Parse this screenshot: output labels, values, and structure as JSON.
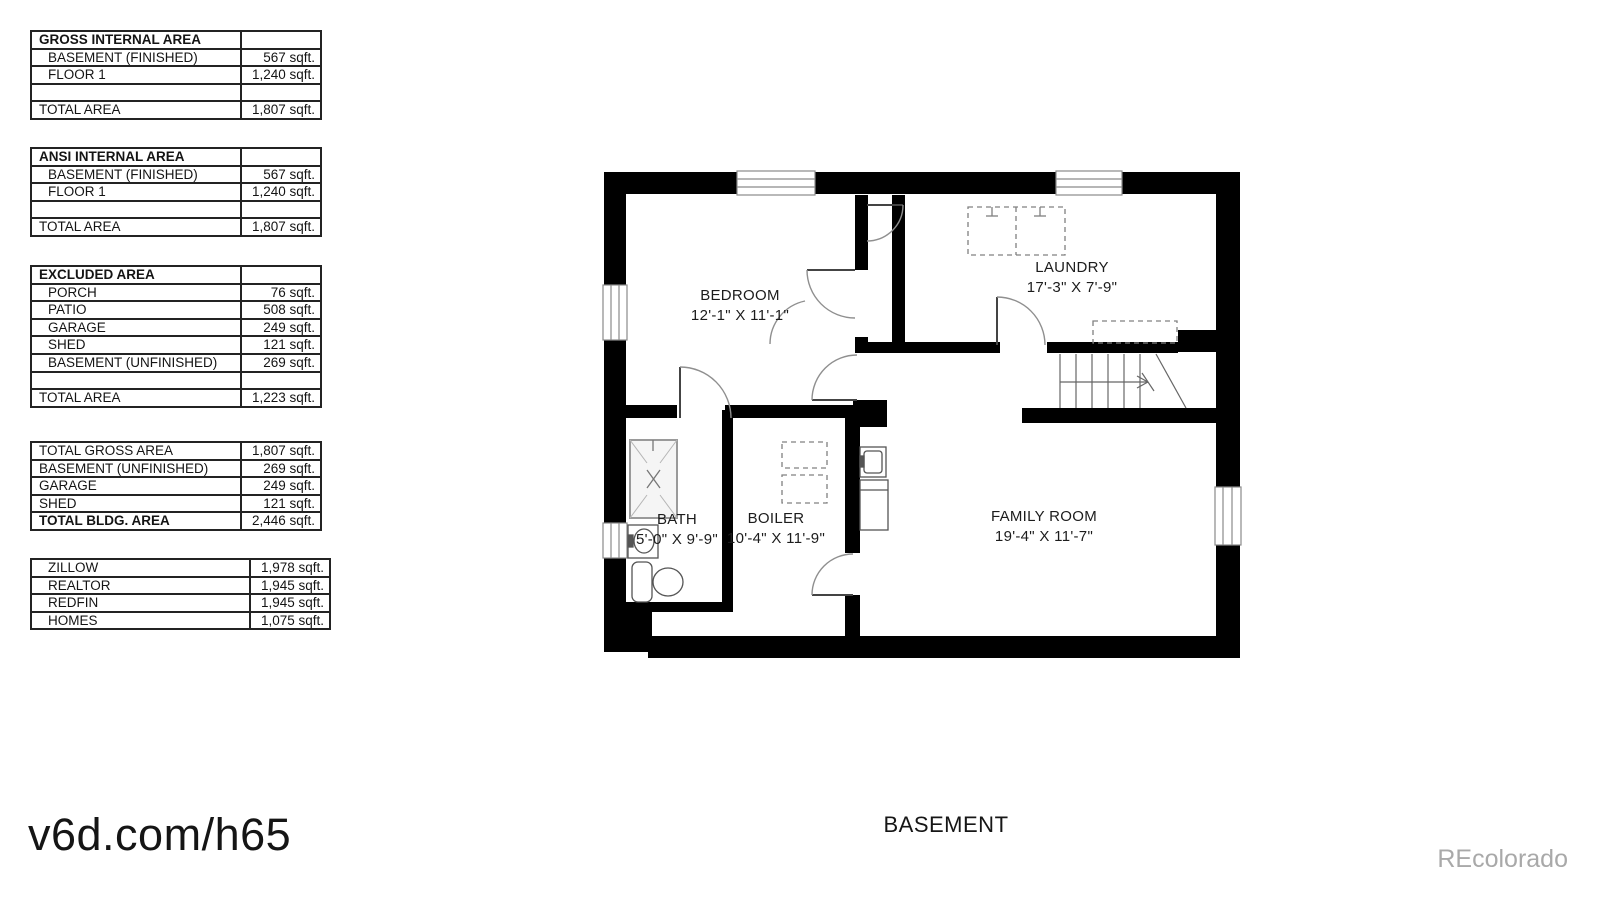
{
  "tables": [
    {
      "title": "GROSS INTERNAL AREA",
      "rows": [
        {
          "label": "BASEMENT (FINISHED)",
          "value": "567 sqft."
        },
        {
          "label": "FLOOR 1",
          "value": "1,240 sqft."
        },
        {
          "label": "",
          "value": ""
        },
        {
          "label": "TOTAL AREA",
          "value": "1,807 sqft."
        }
      ]
    },
    {
      "title": "ANSI INTERNAL AREA",
      "rows": [
        {
          "label": "BASEMENT (FINISHED)",
          "value": "567 sqft."
        },
        {
          "label": "FLOOR 1",
          "value": "1,240 sqft."
        },
        {
          "label": "",
          "value": ""
        },
        {
          "label": "TOTAL AREA",
          "value": "1,807 sqft."
        }
      ]
    },
    {
      "title": "EXCLUDED AREA",
      "rows": [
        {
          "label": "PORCH",
          "value": "76 sqft."
        },
        {
          "label": "PATIO",
          "value": "508 sqft."
        },
        {
          "label": "GARAGE",
          "value": "249 sqft."
        },
        {
          "label": "SHED",
          "value": "121 sqft."
        },
        {
          "label": "BASEMENT (UNFINISHED)",
          "value": "269 sqft."
        },
        {
          "label": "",
          "value": ""
        },
        {
          "label": "TOTAL AREA",
          "value": "1,223 sqft."
        }
      ]
    },
    {
      "title": "",
      "rows": [
        {
          "label": "TOTAL GROSS AREA",
          "value": "1,807 sqft."
        },
        {
          "label": "BASEMENT (UNFINISHED)",
          "value": "269 sqft."
        },
        {
          "label": "GARAGE",
          "value": "249 sqft."
        },
        {
          "label": "SHED",
          "value": "121 sqft."
        },
        {
          "label": "TOTAL BLDG. AREA",
          "value": "2,446 sqft."
        }
      ]
    },
    {
      "title": "",
      "rows": [
        {
          "label": "ZILLOW",
          "value": "1,978 sqft."
        },
        {
          "label": "REALTOR",
          "value": "1,945 sqft."
        },
        {
          "label": "REDFIN",
          "value": "1,945 sqft."
        },
        {
          "label": "HOMES",
          "value": "1,075 sqft."
        }
      ]
    }
  ],
  "floor_plan": {
    "label": "BASEMENT",
    "rooms": [
      {
        "name": "BEDROOM",
        "dims": "12'-1\" X 11'-1\""
      },
      {
        "name": "LAUNDRY",
        "dims": "17'-3\" X 7'-9\""
      },
      {
        "name": "BATH",
        "dims": "5'-0\" X 9'-9\""
      },
      {
        "name": "BOILER",
        "dims": "10'-4\" X 11'-9\""
      },
      {
        "name": "FAMILY ROOM",
        "dims": "19'-4\" X 11'-7\""
      }
    ]
  },
  "watermarks": {
    "site": "v6d.com/h65",
    "brand": "REcolorado"
  },
  "colors": {
    "wall": "#000000",
    "accent_gray": "#a9a9a9"
  }
}
